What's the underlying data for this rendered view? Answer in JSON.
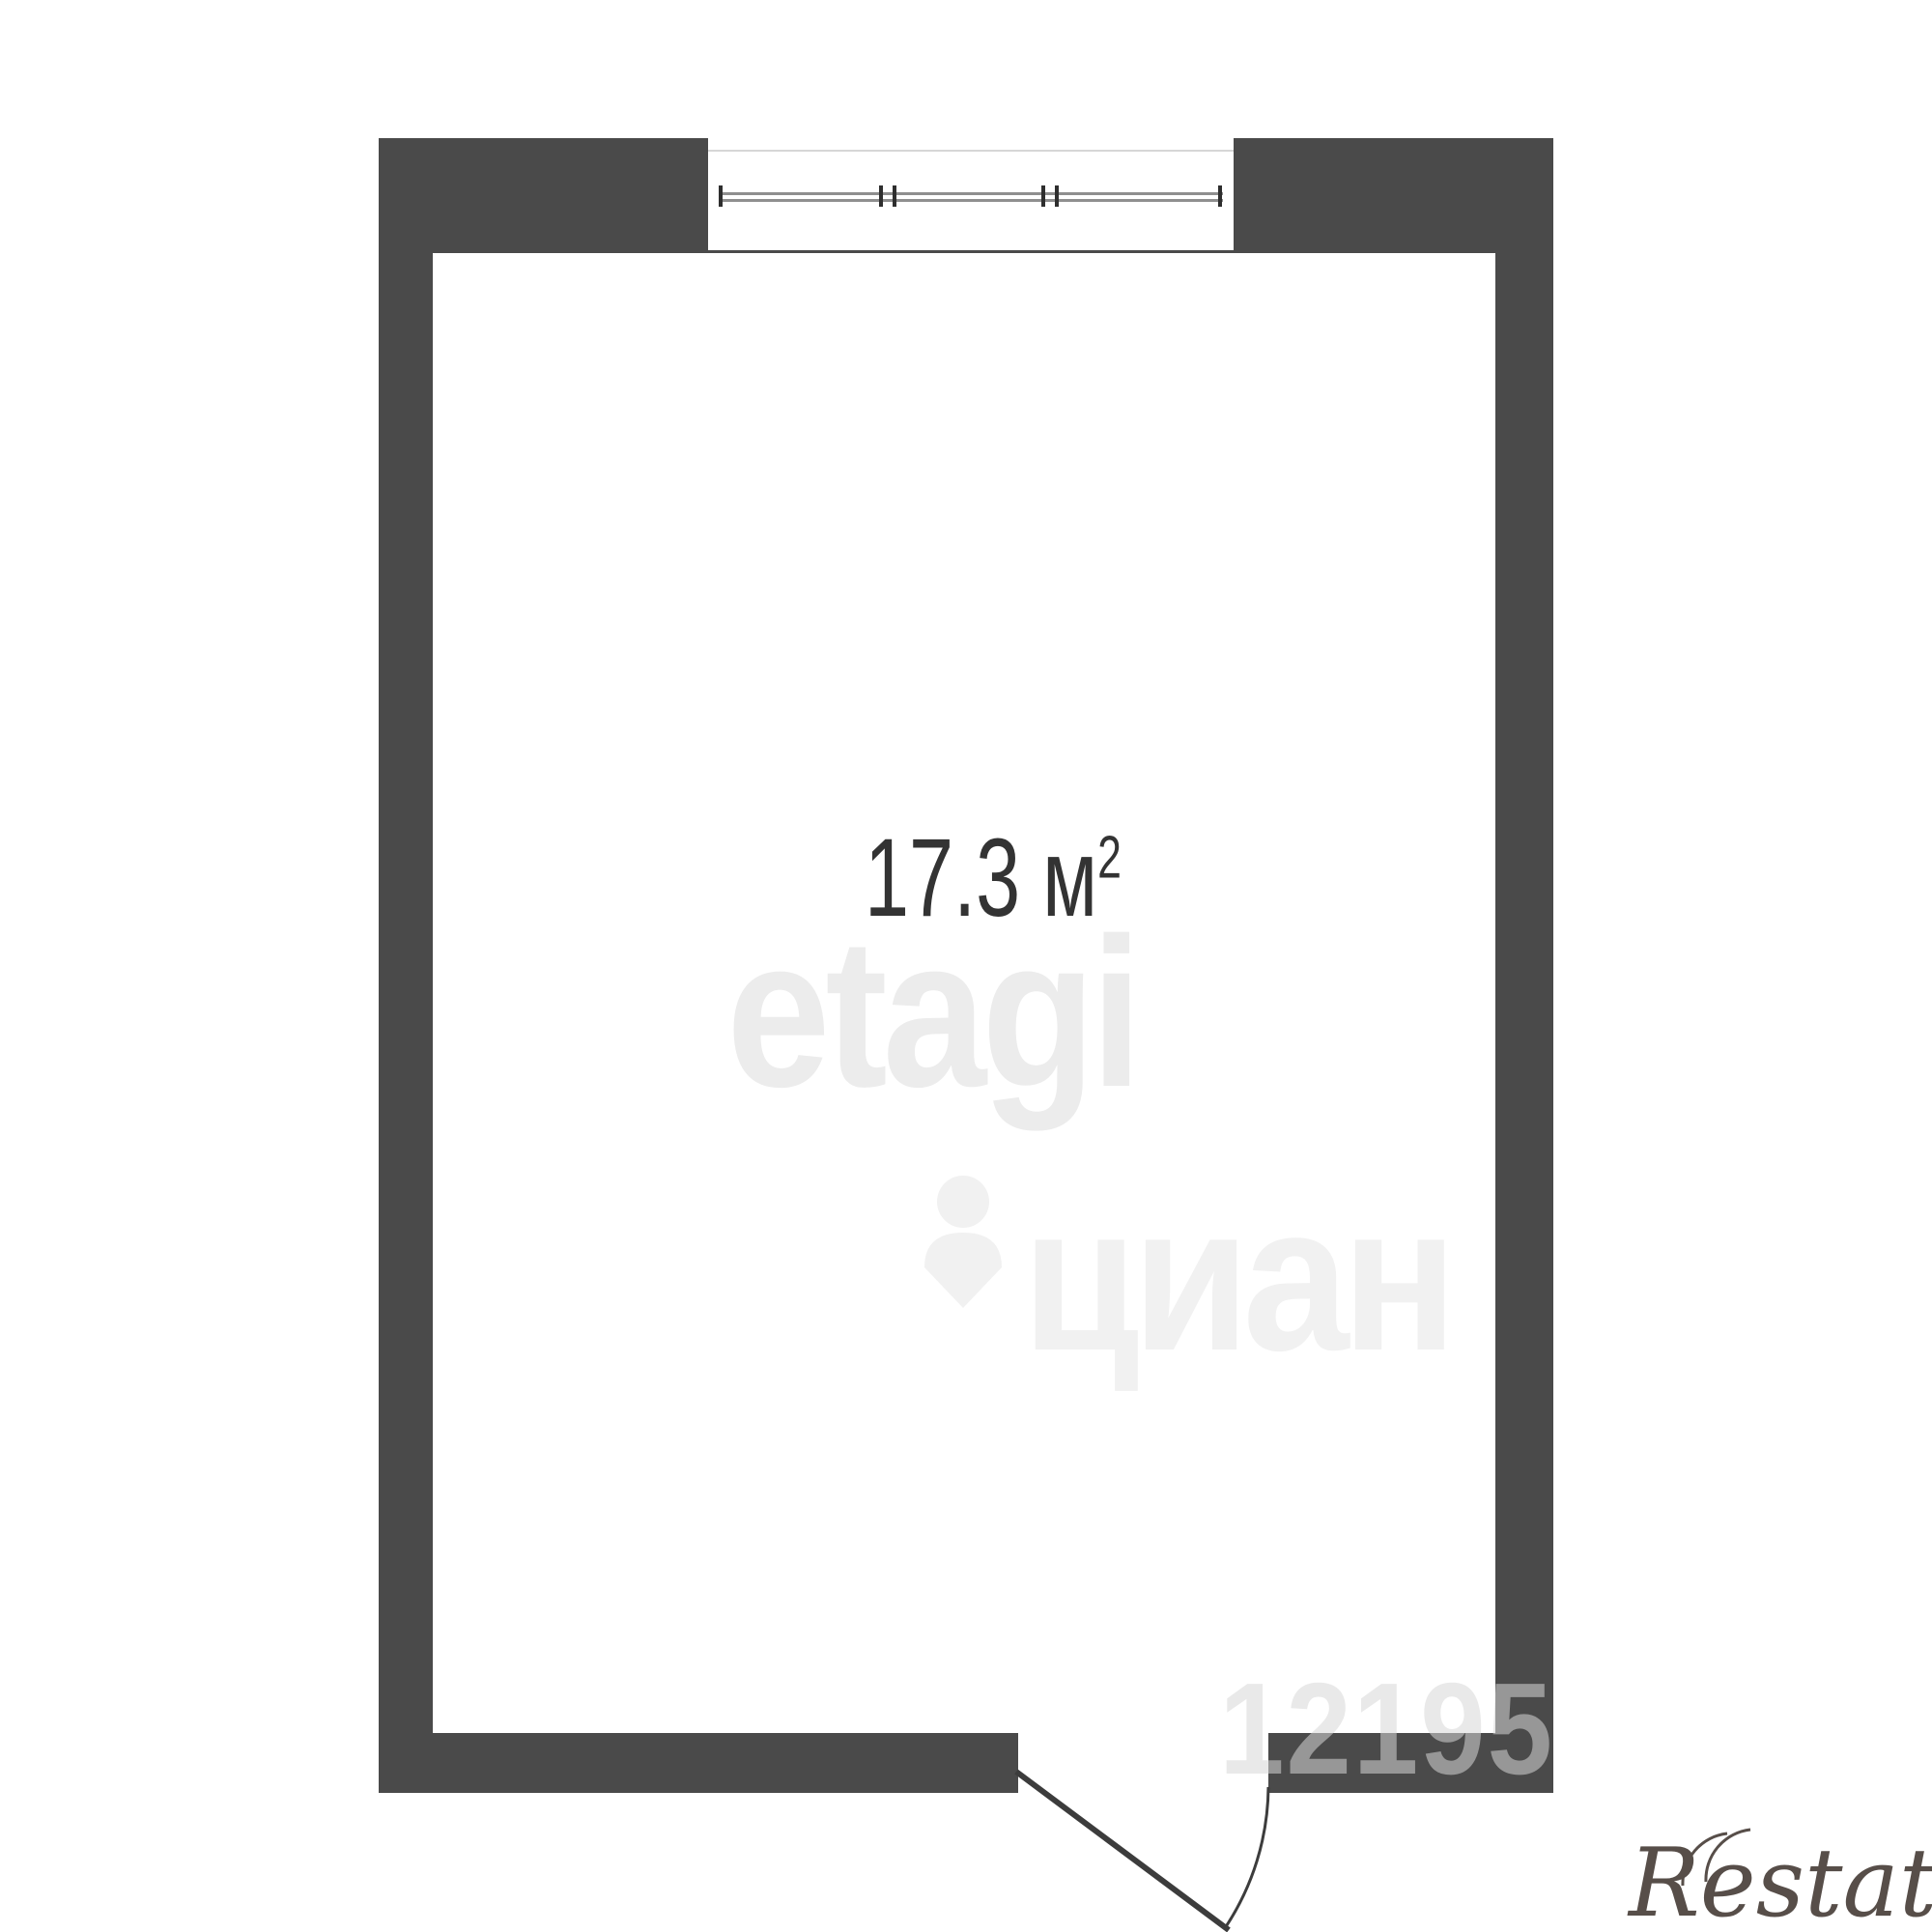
{
  "floorplan": {
    "room": {
      "area_text": "17.3 м",
      "area_exponent": "2",
      "area_label_full": "17.3 м²",
      "label_color": "#333333"
    },
    "wall_color": "#4a4a4a",
    "window": {
      "name": "window",
      "glazing_line_color": "#8f8f8f"
    },
    "door": {
      "name": "door",
      "swing": "outward",
      "line_color": "#3c3c3c"
    }
  },
  "watermarks": {
    "etagi": {
      "text": "etagi",
      "color": "#ececec"
    },
    "cian": {
      "text": "циан",
      "color": "#f1f1f1",
      "icon": "cian-pin-icon"
    },
    "listing_id": {
      "text": "12195",
      "color": "rgba(215,215,215,0.55)"
    },
    "restate": {
      "text": "Restate",
      "color": "#574e49"
    }
  }
}
